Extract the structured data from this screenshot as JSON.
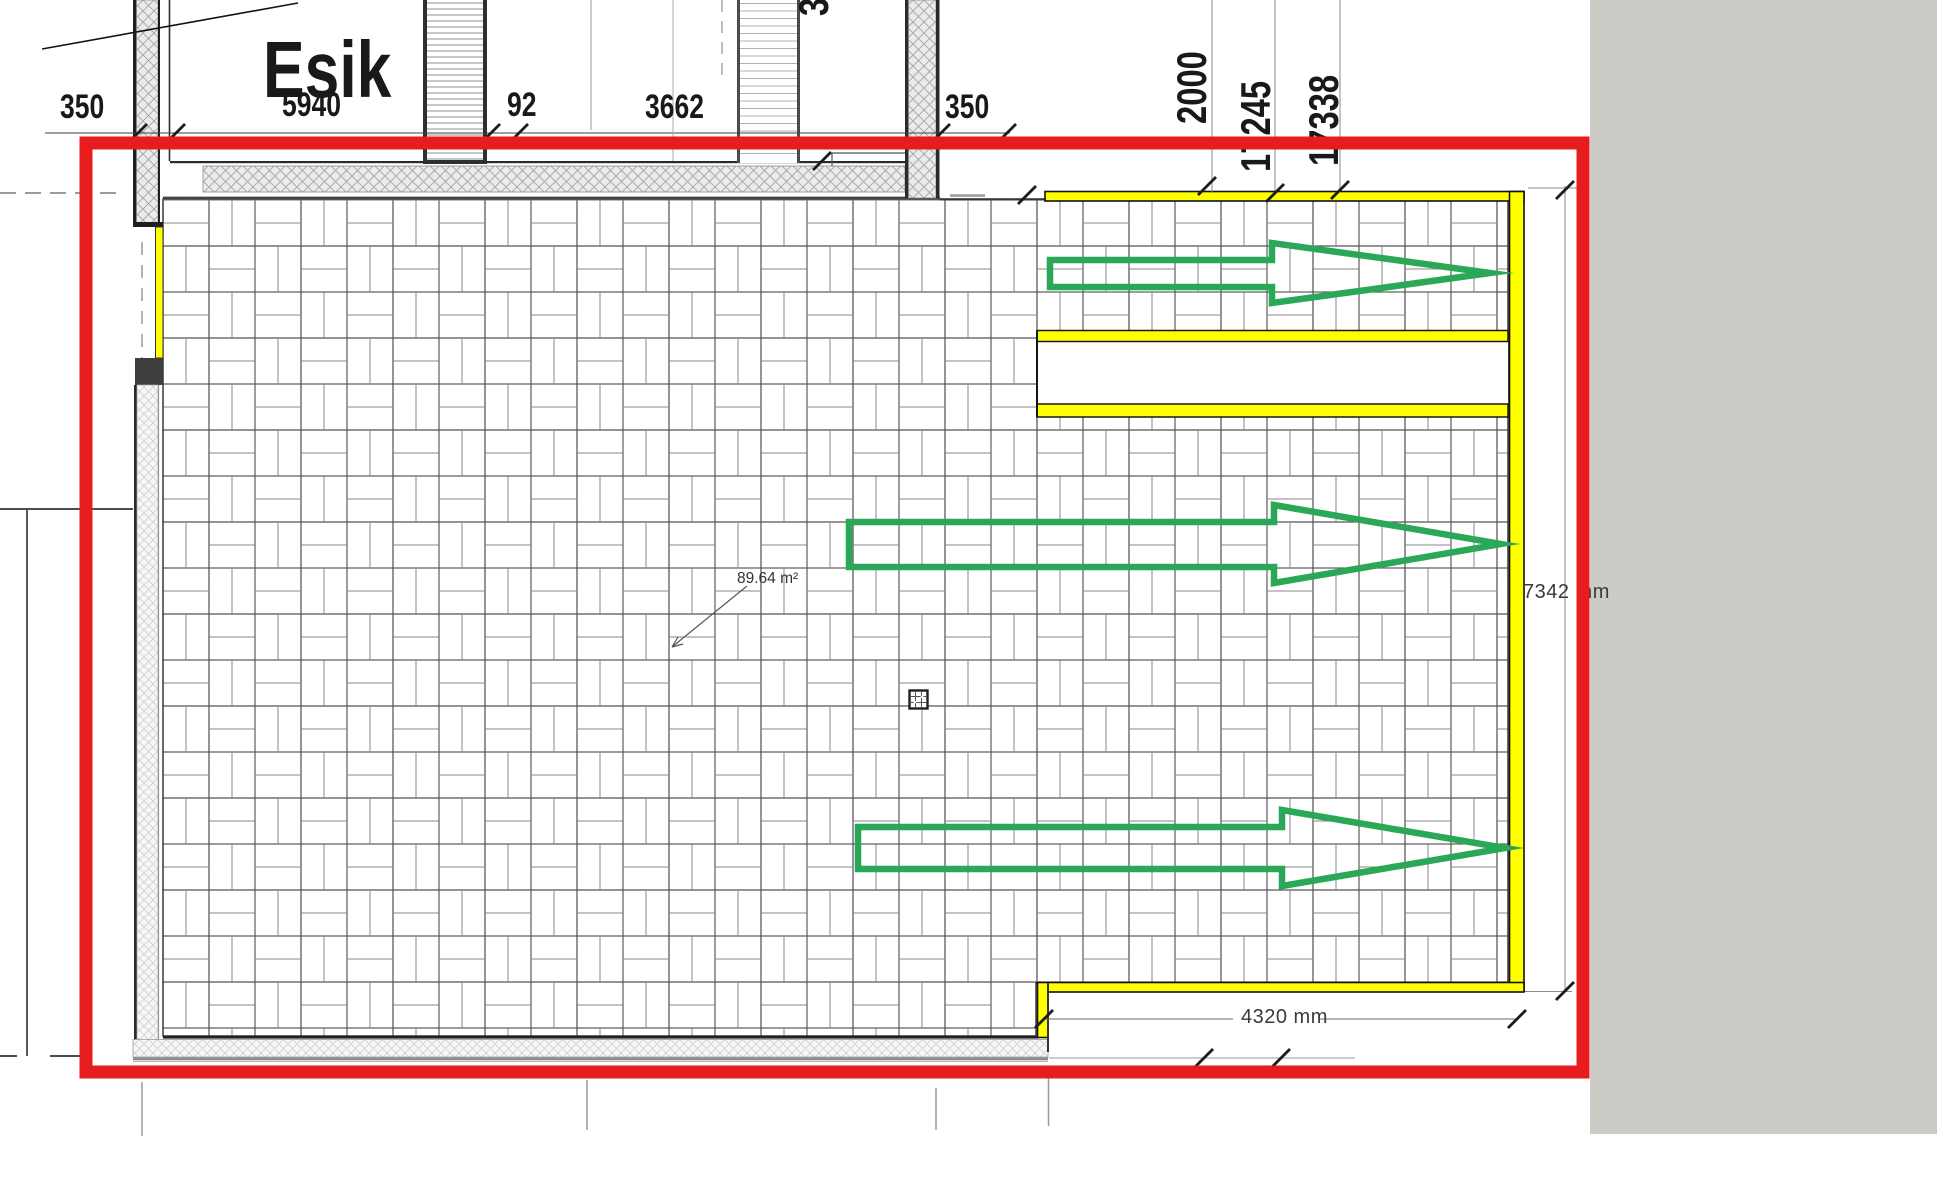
{
  "plan": {
    "room": {
      "name": "Esik",
      "width_label": "5940",
      "area_label": "89.64 m²"
    },
    "dimensions": {
      "d350_left": "350",
      "d92": "92",
      "d3662": "3662",
      "d350_right": "350",
      "v2000": "2000",
      "v17245": "17245",
      "v17338": "17338",
      "v3_partial": "3",
      "right_height": "7342 mm",
      "bottom_width": "4320 mm"
    }
  },
  "colors": {
    "markup_red": "#e71d1d",
    "highlight_yellow": "#ffff00",
    "arrow_green": "#2aa857",
    "panel_gray": "#cccbc5"
  },
  "icons": {
    "grid_icon": "embedded-table-marker"
  }
}
